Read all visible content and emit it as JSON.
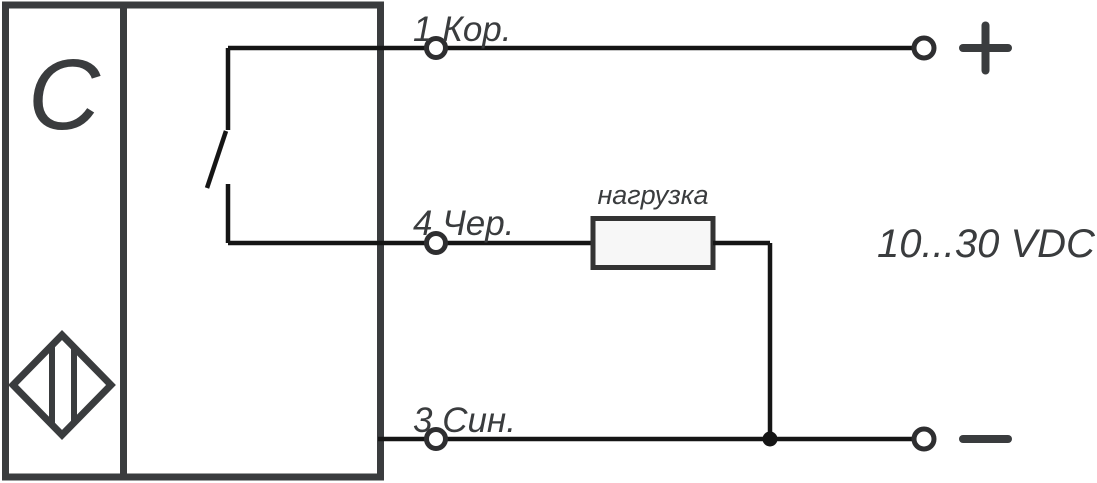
{
  "sensor": {
    "type_label": "C",
    "face_icon": "diamond-proximity-sensor-icon",
    "output_icon": "normally-open-switch-icon"
  },
  "wires": {
    "brown": {
      "label": "1 Кор."
    },
    "black": {
      "label": "4 Чер."
    },
    "blue": {
      "label": "3 Син."
    }
  },
  "load": {
    "label": "нагрузка"
  },
  "supply": {
    "label": "10...30 VDC",
    "plus": "+",
    "minus": "−"
  },
  "colors": {
    "outline": "#3a3c3e",
    "wire": "#151515",
    "background": "#ffffff",
    "load_fill": "#f7f7f7"
  }
}
